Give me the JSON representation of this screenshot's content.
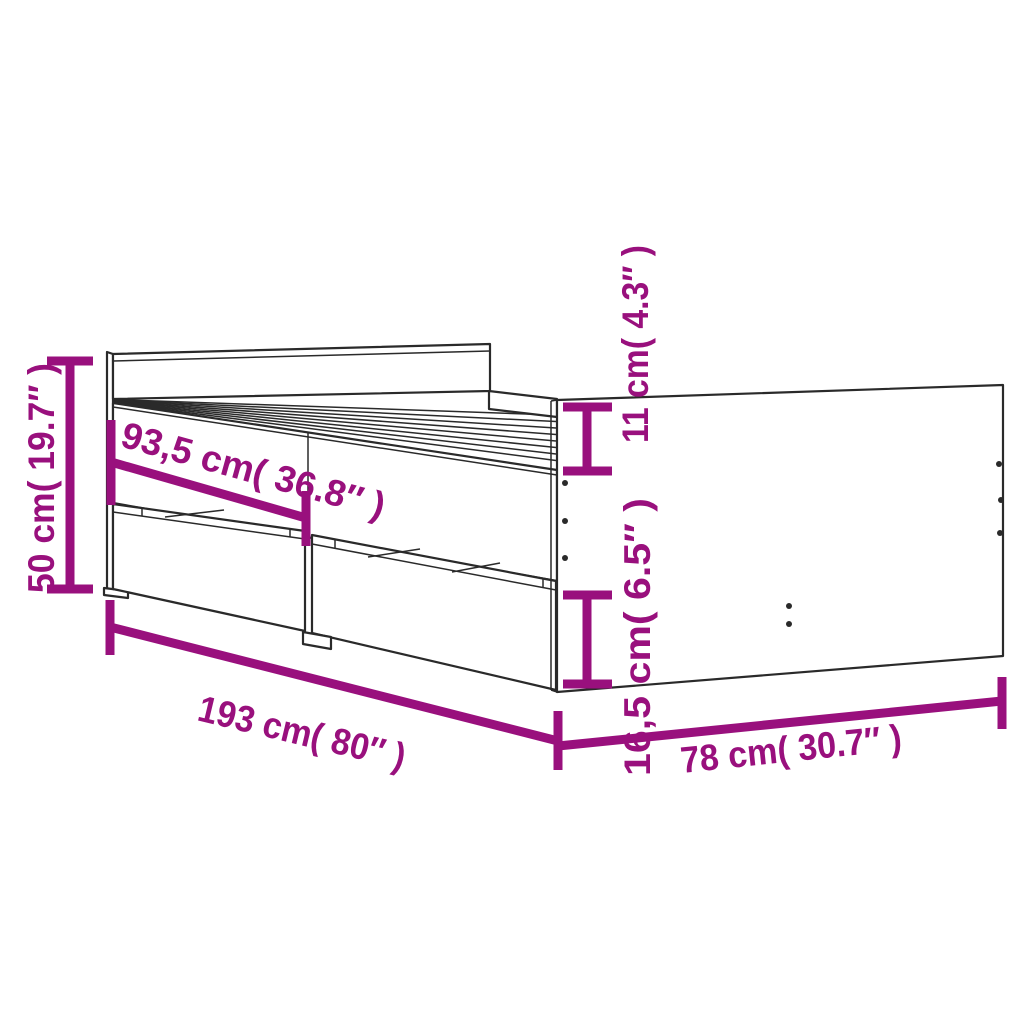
{
  "diagram": {
    "subject": "bed-frame-with-drawers-dimension-diagram",
    "line_color": "#2a2a2a",
    "dimension_color": "#99107d",
    "background_color": "#ffffff",
    "dimensions": [
      {
        "id": "total-height",
        "text": "50 cm( 19.7″ )",
        "cm": "50",
        "inch": "19.7"
      },
      {
        "id": "side-rail-length",
        "text": "93,5 cm( 36.8″ )",
        "cm": "93,5",
        "inch": "36.8"
      },
      {
        "id": "top-rail-height",
        "text": "11 cm( 4.3″ )",
        "cm": "11",
        "inch": "4.3"
      },
      {
        "id": "drawer-height",
        "text": "16,5 cm( 6.5″ )",
        "cm": "16,5",
        "inch": "6.5"
      },
      {
        "id": "total-length",
        "text": "193 cm( 80″ )",
        "cm": "193",
        "inch": "80"
      },
      {
        "id": "total-width",
        "text": "78 cm( 30.7″ )",
        "cm": "78",
        "inch": "30.7"
      }
    ]
  }
}
